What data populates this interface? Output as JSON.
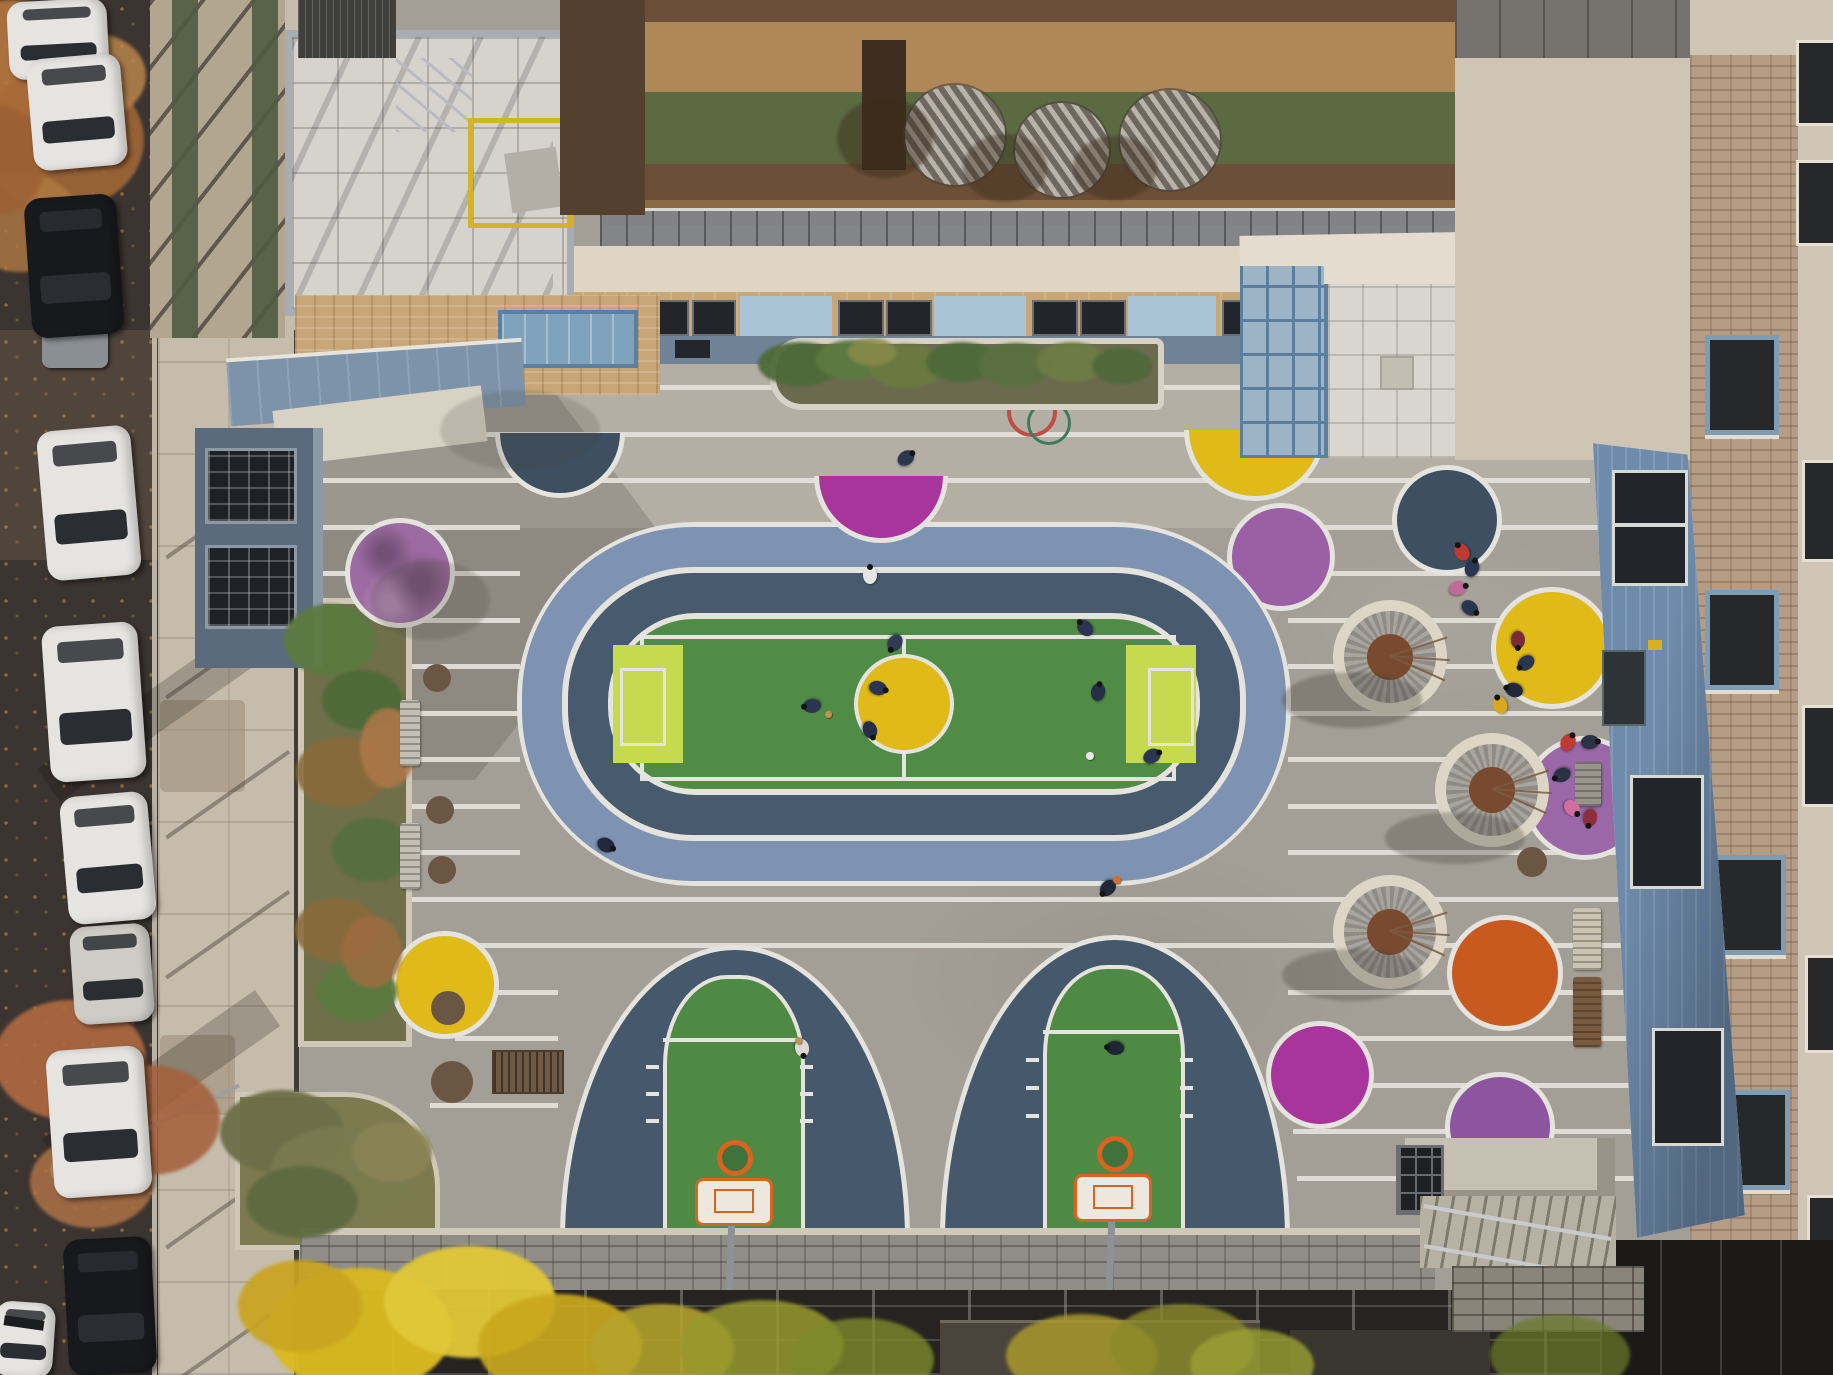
{
  "scene": {
    "description": "Aerial drone photograph of a colorful schoolyard courtyard: oval running track with soccer field and yellow center circle, two arched basketball courts, grey pavement with white stripes and painted color dots, circular tree planters, surrounded by school buildings, a rooftop terrace and a street with parked cars",
    "width": 1833,
    "height": 1375
  },
  "palette": {
    "street": "#3b3430",
    "sidewalk": "#c6bcab",
    "pavement": "#a49f96",
    "pavementLight": "#b4afa5",
    "stripe": "#e2dfd7",
    "white": "#e5e3dd",
    "trackOuter": "#7e93b2",
    "trackInner": "#475a6e",
    "field": "#518c46",
    "lime": "#c6da4f",
    "court": "#46586b",
    "courtGreen": "#4e8a44",
    "orangeHoop": "#d8641f",
    "yellow": "#dfba19",
    "navy": "#3d4f61",
    "magenta": "#a8359b",
    "violet": "#9c6ba1",
    "purple": "#8d54a0",
    "purple2": "#9b5fa5",
    "orchid": "#9a68a6",
    "orange": "#c8591f",
    "stool": "#6b5644",
    "mulch": "#7a4a30",
    "ringOuter": "#ddd6c6",
    "brickRing": "#908c85",
    "terrace": "#a87f52",
    "terraceDark": "#6b4f38",
    "terraceBand": "#b08756",
    "terraceGreen": "#5c6a42",
    "brick": "#c8a678",
    "cream": "#ded5c4",
    "creamBldg": "#cfc5b4",
    "blueRoof": "#7d93a9",
    "blueSiding": "#6e8bab",
    "slateWall": "#5b6b7d",
    "glass": "#9db4c6",
    "wallBand": "#8f8d86",
    "scaffold": "#262320",
    "curb": "#cfc8b8",
    "carWhite": "#e6e4e0",
    "carSilver": "#cfccc6",
    "carBlack": "#17191c",
    "carGlass": "#2a2e33"
  },
  "stripes": [
    [
      310,
      385,
      930
    ],
    [
      310,
      432,
      930
    ],
    [
      310,
      478,
      1280
    ],
    [
      310,
      525,
      210
    ],
    [
      1288,
      525,
      310
    ],
    [
      310,
      571,
      210
    ],
    [
      1288,
      571,
      330
    ],
    [
      310,
      618,
      210
    ],
    [
      1288,
      618,
      335
    ],
    [
      310,
      664,
      210
    ],
    [
      1288,
      664,
      340
    ],
    [
      310,
      711,
      210
    ],
    [
      1288,
      711,
      345
    ],
    [
      310,
      757,
      210
    ],
    [
      1288,
      757,
      350
    ],
    [
      310,
      804,
      210
    ],
    [
      1288,
      804,
      350
    ],
    [
      310,
      850,
      210
    ],
    [
      1288,
      850,
      355
    ],
    [
      310,
      897,
      1335
    ],
    [
      310,
      943,
      1340
    ],
    [
      430,
      990,
      128
    ],
    [
      1288,
      990,
      365
    ],
    [
      455,
      1036,
      103
    ],
    [
      1288,
      1036,
      370
    ],
    [
      430,
      1103,
      128
    ],
    [
      1290,
      1083,
      372
    ],
    [
      1293,
      1129,
      372
    ],
    [
      1297,
      1176,
      375
    ]
  ],
  "circlesUnder": [
    {
      "x": 1281,
      "y": 557,
      "r": 49,
      "c": "purple2"
    }
  ],
  "circlesOver": [
    {
      "x": 560,
      "y": 433,
      "r": 60,
      "c": "navy",
      "half": 1
    },
    {
      "x": 881,
      "y": 476,
      "r": 62,
      "c": "magenta",
      "half": 1
    },
    {
      "x": 1255,
      "y": 430,
      "r": 66,
      "c": "yellow",
      "half": 1
    },
    {
      "x": 400,
      "y": 573,
      "r": 50,
      "c": "violet",
      "mottle": 1
    },
    {
      "x": 1447,
      "y": 520,
      "r": 50,
      "c": "navy"
    },
    {
      "x": 1552,
      "y": 648,
      "r": 56,
      "c": "yellow"
    },
    {
      "x": 445,
      "y": 985,
      "r": 49,
      "c": "yellow"
    },
    {
      "x": 1505,
      "y": 973,
      "r": 53,
      "c": "orange"
    },
    {
      "x": 1320,
      "y": 1075,
      "r": 49,
      "c": "magenta"
    },
    {
      "x": 1500,
      "y": 1127,
      "r": 50,
      "c": "purple"
    },
    {
      "x": 1585,
      "y": 798,
      "r": 57,
      "c": "orchid"
    },
    {
      "x": 437,
      "y": 678,
      "r": 14,
      "c": "stool",
      "ring": 0
    },
    {
      "x": 440,
      "y": 810,
      "r": 14,
      "c": "stool",
      "ring": 0
    },
    {
      "x": 442,
      "y": 870,
      "r": 14,
      "c": "stool",
      "ring": 0
    },
    {
      "x": 448,
      "y": 1008,
      "r": 17,
      "c": "stool",
      "ring": 0
    },
    {
      "x": 1532,
      "y": 862,
      "r": 15,
      "c": "stool",
      "ring": 0
    },
    {
      "x": 452,
      "y": 1082,
      "r": 21,
      "c": "stool",
      "ring": 0
    }
  ],
  "treePlanters": [
    {
      "x": 1390,
      "y": 657
    },
    {
      "x": 1492,
      "y": 790
    },
    {
      "x": 1390,
      "y": 932
    }
  ],
  "terraceTables": [
    {
      "x": 955,
      "y": 135,
      "r": 50
    },
    {
      "x": 1062,
      "y": 150,
      "r": 47
    },
    {
      "x": 1170,
      "y": 140,
      "r": 50
    }
  ],
  "cars": [
    {
      "x": 8,
      "y": 0,
      "w": 100,
      "h": 78,
      "d": -3,
      "c": "carWhite"
    },
    {
      "x": 30,
      "y": 56,
      "w": 94,
      "h": 112,
      "d": -5,
      "c": "carWhite"
    },
    {
      "x": 28,
      "y": 196,
      "w": 92,
      "h": 140,
      "d": -4,
      "c": "carBlack"
    },
    {
      "x": 42,
      "y": 428,
      "w": 94,
      "h": 150,
      "d": -5,
      "c": "carWhite"
    },
    {
      "x": 46,
      "y": 624,
      "w": 96,
      "h": 156,
      "d": -4,
      "c": "carWhite"
    },
    {
      "x": 64,
      "y": 794,
      "w": 88,
      "h": 128,
      "d": -5,
      "c": "carWhite"
    },
    {
      "x": 72,
      "y": 925,
      "w": 80,
      "h": 98,
      "d": -4,
      "c": "carSilver"
    },
    {
      "x": 50,
      "y": 1048,
      "w": 98,
      "h": 148,
      "d": -4,
      "c": "carWhite"
    },
    {
      "x": 66,
      "y": 1238,
      "w": 88,
      "h": 136,
      "d": -3,
      "c": "carBlack"
    },
    {
      "x": -6,
      "y": 1302,
      "w": 60,
      "h": 75,
      "d": 4,
      "c": "carWhite"
    }
  ],
  "people": [
    [
      870,
      575,
      "#e8e6e2"
    ],
    [
      906,
      458,
      "#2e3650"
    ],
    [
      878,
      688,
      "#2b3550"
    ],
    [
      870,
      730,
      "#262f48"
    ],
    [
      895,
      643,
      "#303a55"
    ],
    [
      812,
      706,
      "#2b3550"
    ],
    [
      1085,
      628,
      "#2b3550"
    ],
    [
      1098,
      692,
      "#262f48"
    ],
    [
      1152,
      756,
      "#2b3550"
    ],
    [
      606,
      845,
      "#22293d"
    ],
    [
      802,
      1048,
      "#ddd8d0"
    ],
    [
      1108,
      888,
      "#1f2738"
    ],
    [
      1115,
      1048,
      "#1f2636"
    ],
    [
      1462,
      552,
      "#c03a34"
    ],
    [
      1472,
      568,
      "#2b3550"
    ],
    [
      1458,
      588,
      "#c06a9a"
    ],
    [
      1470,
      608,
      "#2b3550"
    ],
    [
      1518,
      640,
      "#7a2a38"
    ],
    [
      1526,
      663,
      "#2b3550"
    ],
    [
      1514,
      690,
      "#23293b"
    ],
    [
      1500,
      705,
      "#d8a820"
    ],
    [
      1568,
      742,
      "#c03a34"
    ],
    [
      1590,
      742,
      "#2b3244"
    ],
    [
      1572,
      808,
      "#cf6fa0"
    ],
    [
      1590,
      818,
      "#8d2f3b"
    ],
    [
      1562,
      775,
      "#2b3244"
    ]
  ],
  "balls": [
    [
      828,
      714,
      "#c89050",
      7
    ],
    [
      1090,
      756,
      "#e8e8e8",
      8
    ],
    [
      1117,
      880,
      "#d07030",
      8
    ],
    [
      798,
      1040,
      "#c89050",
      7
    ]
  ],
  "benches": [
    [
      400,
      700,
      20,
      66,
      "v",
      "#c4bfb4"
    ],
    [
      400,
      823,
      20,
      66,
      "v",
      "#c4bfb4"
    ],
    [
      1575,
      762,
      26,
      44,
      "v",
      "#9a958c"
    ],
    [
      1573,
      908,
      28,
      62,
      "v",
      "#cac3b2"
    ],
    [
      1573,
      977,
      28,
      70,
      "v",
      "#7a5a3f"
    ]
  ],
  "foliage": [
    [
      10,
      60,
      70,
      60,
      "#b5763f",
      0.9
    ],
    [
      62,
      140,
      82,
      70,
      "#a86a38",
      0.85
    ],
    [
      20,
      222,
      60,
      50,
      "#b07a42",
      0.8
    ],
    [
      96,
      76,
      50,
      42,
      "#c08a4d",
      0.8
    ],
    [
      0,
      160,
      45,
      55,
      "#9c6034",
      0.8
    ],
    [
      70,
      1060,
      76,
      60,
      "#b06a42",
      0.9
    ],
    [
      150,
      1120,
      70,
      55,
      "#a55f3a",
      0.85
    ],
    [
      92,
      1182,
      62,
      46,
      "#b5764a",
      0.8
    ],
    [
      330,
      640,
      46,
      36,
      "#5c7a40",
      0.95
    ],
    [
      362,
      700,
      40,
      30,
      "#4e6a36",
      0.95
    ],
    [
      342,
      772,
      46,
      35,
      "#8a6a3a",
      0.9
    ],
    [
      372,
      850,
      40,
      32,
      "#567040",
      0.95
    ],
    [
      337,
      930,
      42,
      32,
      "#8a6a3a",
      0.9
    ],
    [
      357,
      992,
      40,
      30,
      "#5c7a40",
      0.95
    ],
    [
      388,
      748,
      28,
      40,
      "#b07848",
      0.85
    ],
    [
      372,
      952,
      30,
      36,
      "#a06c40",
      0.8
    ],
    [
      800,
      364,
      42,
      22,
      "#4e6a38",
      0.95
    ],
    [
      852,
      360,
      36,
      20,
      "#5c7a42",
      0.95
    ],
    [
      906,
      366,
      38,
      22,
      "#6b7a40",
      0.95
    ],
    [
      962,
      362,
      36,
      20,
      "#4e6a38",
      0.95
    ],
    [
      1016,
      365,
      38,
      22,
      "#5a7040",
      0.95
    ],
    [
      1072,
      362,
      36,
      20,
      "#6e7c44",
      0.95
    ],
    [
      1122,
      366,
      30,
      18,
      "#50683a",
      0.95
    ],
    [
      872,
      352,
      24,
      14,
      "#8a8a4a",
      0.85
    ],
    [
      282,
      1132,
      62,
      42,
      "#6e6e48",
      0.95
    ],
    [
      342,
      1172,
      72,
      46,
      "#7a7a50",
      0.95
    ],
    [
      302,
      1202,
      56,
      36,
      "#5f6a40",
      0.95
    ],
    [
      392,
      1152,
      40,
      30,
      "#8a8456",
      0.9
    ],
    [
      360,
      1330,
      92,
      62,
      "#d9b922",
      0.97
    ],
    [
      470,
      1302,
      86,
      56,
      "#e2c838",
      0.95
    ],
    [
      560,
      1346,
      82,
      52,
      "#c9a81e",
      0.92
    ],
    [
      300,
      1306,
      62,
      46,
      "#caa520",
      0.92
    ],
    [
      662,
      1350,
      72,
      46,
      "#b5a42c",
      0.88
    ],
    [
      762,
      1346,
      82,
      46,
      "#97992e",
      0.85
    ],
    [
      862,
      1360,
      72,
      42,
      "#7c8a2c",
      0.8
    ],
    [
      1082,
      1356,
      76,
      42,
      "#a9992c",
      0.85
    ],
    [
      1182,
      1346,
      72,
      42,
      "#8a8a2a",
      0.8
    ],
    [
      1252,
      1365,
      62,
      36,
      "#9aa132",
      0.8
    ],
    [
      1560,
      1355,
      70,
      40,
      "#6b7a2a",
      0.7
    ],
    [
      885,
      138,
      48,
      40,
      "#3a2a1a",
      0.45
    ],
    [
      1005,
      168,
      42,
      34,
      "#3a2a1a",
      0.4
    ],
    [
      1115,
      168,
      42,
      32,
      "#3a2a1a",
      0.4
    ],
    [
      1352,
      700,
      70,
      28,
      "#3a362f",
      0.3
    ],
    [
      1455,
      838,
      70,
      26,
      "#3a362f",
      0.28
    ],
    [
      1352,
      975,
      70,
      26,
      "#3a362f",
      0.28
    ],
    [
      430,
      600,
      60,
      40,
      "#4a443c",
      0.22
    ],
    [
      520,
      430,
      80,
      40,
      "#4a443c",
      0.18
    ]
  ]
}
